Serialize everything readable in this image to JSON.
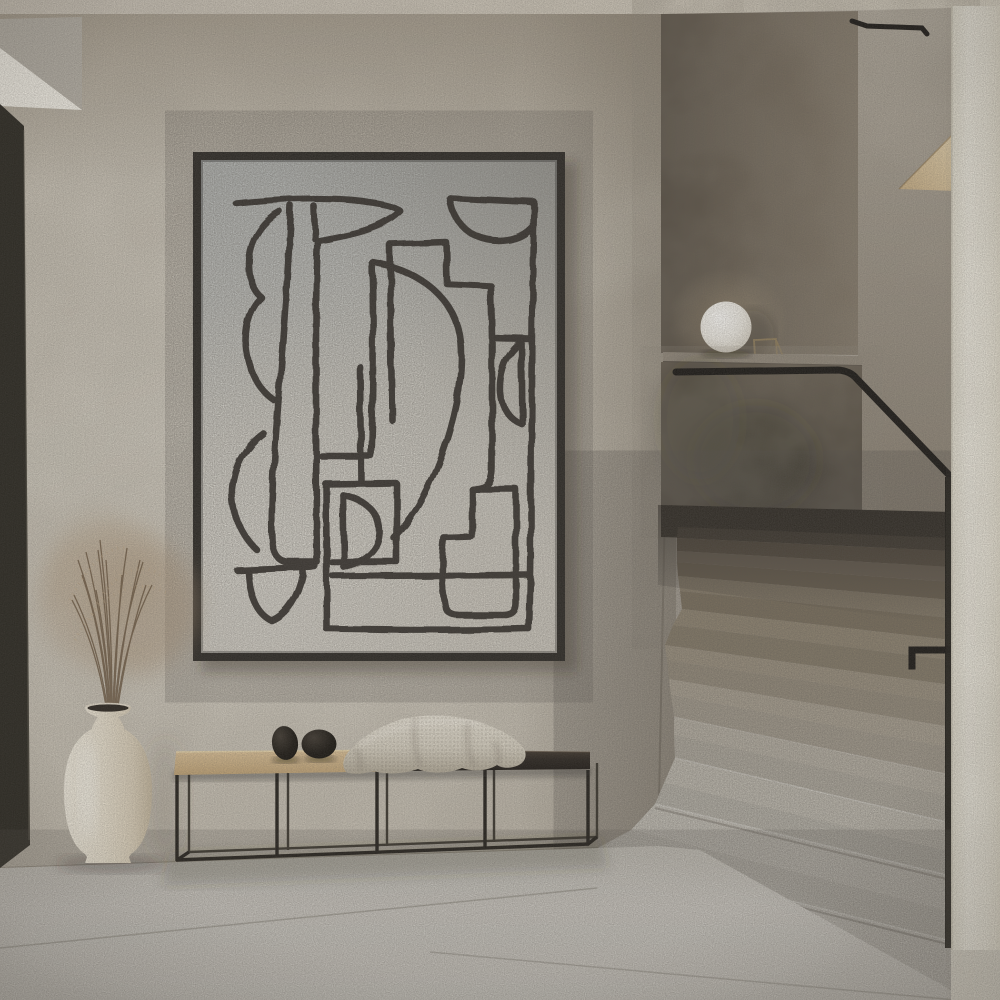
{
  "scene": {
    "type": "interior-photograph",
    "setting": "minimalist beige hallway with framed abstract line-art, bench and terrazzo staircase",
    "visible_text": "none"
  },
  "artwork": {
    "kind": "abstract black one-line drawing poster",
    "frame": "thin black gallery frame",
    "paper": "off-white textured paper"
  },
  "furniture": {
    "bench": "long black steel-frame bench, tan leather left seat, dark wood right seat",
    "bench_objects": [
      "black stone",
      "black stone",
      "cream waffle-knit throw"
    ]
  },
  "decor": {
    "vase": "cream ceramic floor vase",
    "plant": "dried beige grass bouquet",
    "lamp": "white sphere lamp on stair ledge",
    "shelf": "small oak wedge shelf on stair wall"
  },
  "architecture": {
    "staircase": "terrazzo stairs, bright lower flight, shadowed upper flight",
    "handrail": "thin black metal handrail",
    "visible_steps": 10,
    "walls": "textured plaster, greige and smoked umber"
  },
  "colors": {
    "art_frame": "#211f1b",
    "art_line": "#2a2722",
    "handrail": "#1a1815",
    "bench_frame": "#24211c",
    "bench_frame_back": "#3b372f",
    "seat_dark_edge": "#6b5d4c",
    "pebble": "#17140f",
    "wood_shelf": "#d9c29b",
    "door_edge": "#292720",
    "ledge": "#968d7f",
    "rail_strip": "#1f1d18"
  }
}
